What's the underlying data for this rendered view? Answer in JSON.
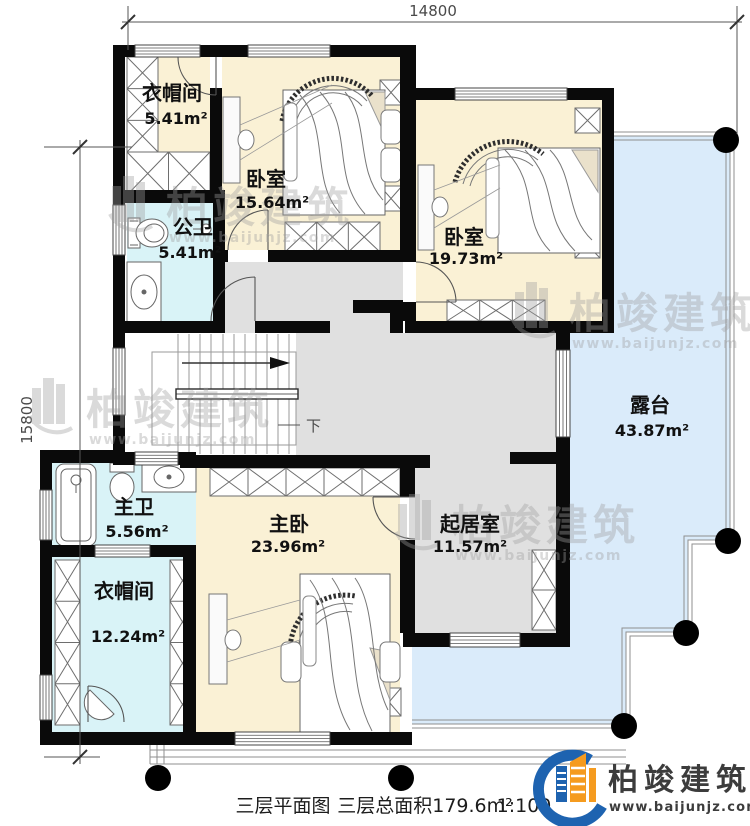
{
  "dimensions": {
    "top": "14800",
    "left": "15800"
  },
  "rooms": [
    {
      "id": "cloakroom-upper",
      "name": "衣帽间",
      "area": "5.41m²"
    },
    {
      "id": "bedroom-1",
      "name": "卧室",
      "area": "15.64m²"
    },
    {
      "id": "public-bathroom",
      "name": "公卫",
      "area": "5.41m²"
    },
    {
      "id": "bedroom-2",
      "name": "卧室",
      "area": "19.73m²"
    },
    {
      "id": "terrace",
      "name": "露台",
      "area": "43.87m²"
    },
    {
      "id": "master-bathroom",
      "name": "主卫",
      "area": "5.56m²"
    },
    {
      "id": "master-bedroom",
      "name": "主卧",
      "area": "23.96m²"
    },
    {
      "id": "living-room",
      "name": "起居室",
      "area": "11.57m²"
    },
    {
      "id": "cloakroom-lower",
      "name": "衣帽间",
      "area": "12.24m²"
    }
  ],
  "stairs": {
    "down_label": "下"
  },
  "caption": {
    "title": "三层平面图",
    "total_area": "三层总面积179.6m²",
    "scale": "1:100"
  },
  "logo": {
    "name": "柏竣建筑",
    "url": "www.baijunjz.com"
  },
  "watermark": {
    "name": "柏竣建筑",
    "url": "www.baijunjz.com"
  },
  "colors": {
    "bedroom_floor": "#FAF1D5",
    "bath_floor": "#D9F3F7",
    "hall_floor": "#E0E0E0",
    "terrace_floor": "#DAEBFA",
    "wall": "#0A0A0A",
    "logo_blue": "#1E63B0",
    "logo_orange": "#F59B1F"
  }
}
